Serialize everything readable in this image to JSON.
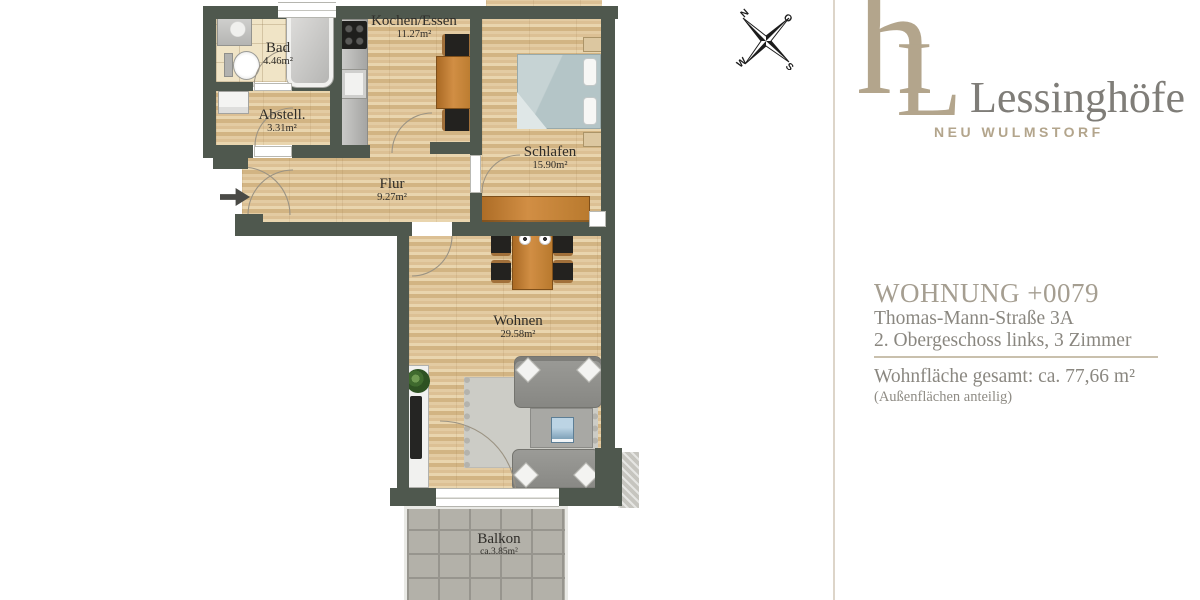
{
  "compass": {
    "north": "N",
    "east": "O",
    "south": "S",
    "west": "W"
  },
  "plan": {
    "rooms": [
      {
        "id": "bad",
        "name": "Bad",
        "area": "4.46m²"
      },
      {
        "id": "abstell",
        "name": "Abstell.",
        "area": "3.31m²"
      },
      {
        "id": "kochen",
        "name": "Kochen/Essen",
        "area": "11.27m²"
      },
      {
        "id": "schlafen",
        "name": "Schlafen",
        "area": "15.90m²"
      },
      {
        "id": "flur",
        "name": "Flur",
        "area": "9.27m²"
      },
      {
        "id": "wohnen",
        "name": "Wohnen",
        "area": "29.58m²"
      },
      {
        "id": "balkon",
        "name": "Balkon",
        "area": "ca.3.85m²"
      }
    ],
    "colors": {
      "wall": "#4f584e",
      "wood": "#dfc69c",
      "bath_tile": "#f0e4c6",
      "balcony_tile": "#b3b1a9"
    }
  },
  "branding": {
    "logo_h": "h",
    "logo_l": "L",
    "name": "Lessinghöfe",
    "location": "NEU WULMSTORF",
    "accent_color": "#b3a58c",
    "text_color": "#7f7d78"
  },
  "details": {
    "unit_title": "WOHNUNG +0079",
    "address": "Thomas-Mann-Straße 3A",
    "floor_info": "2. Obergeschoss links, 3 Zimmer",
    "area_total": "Wohnfläche gesamt: ca. 77,66 m²",
    "area_note": "(Außenflächen anteilig)"
  }
}
